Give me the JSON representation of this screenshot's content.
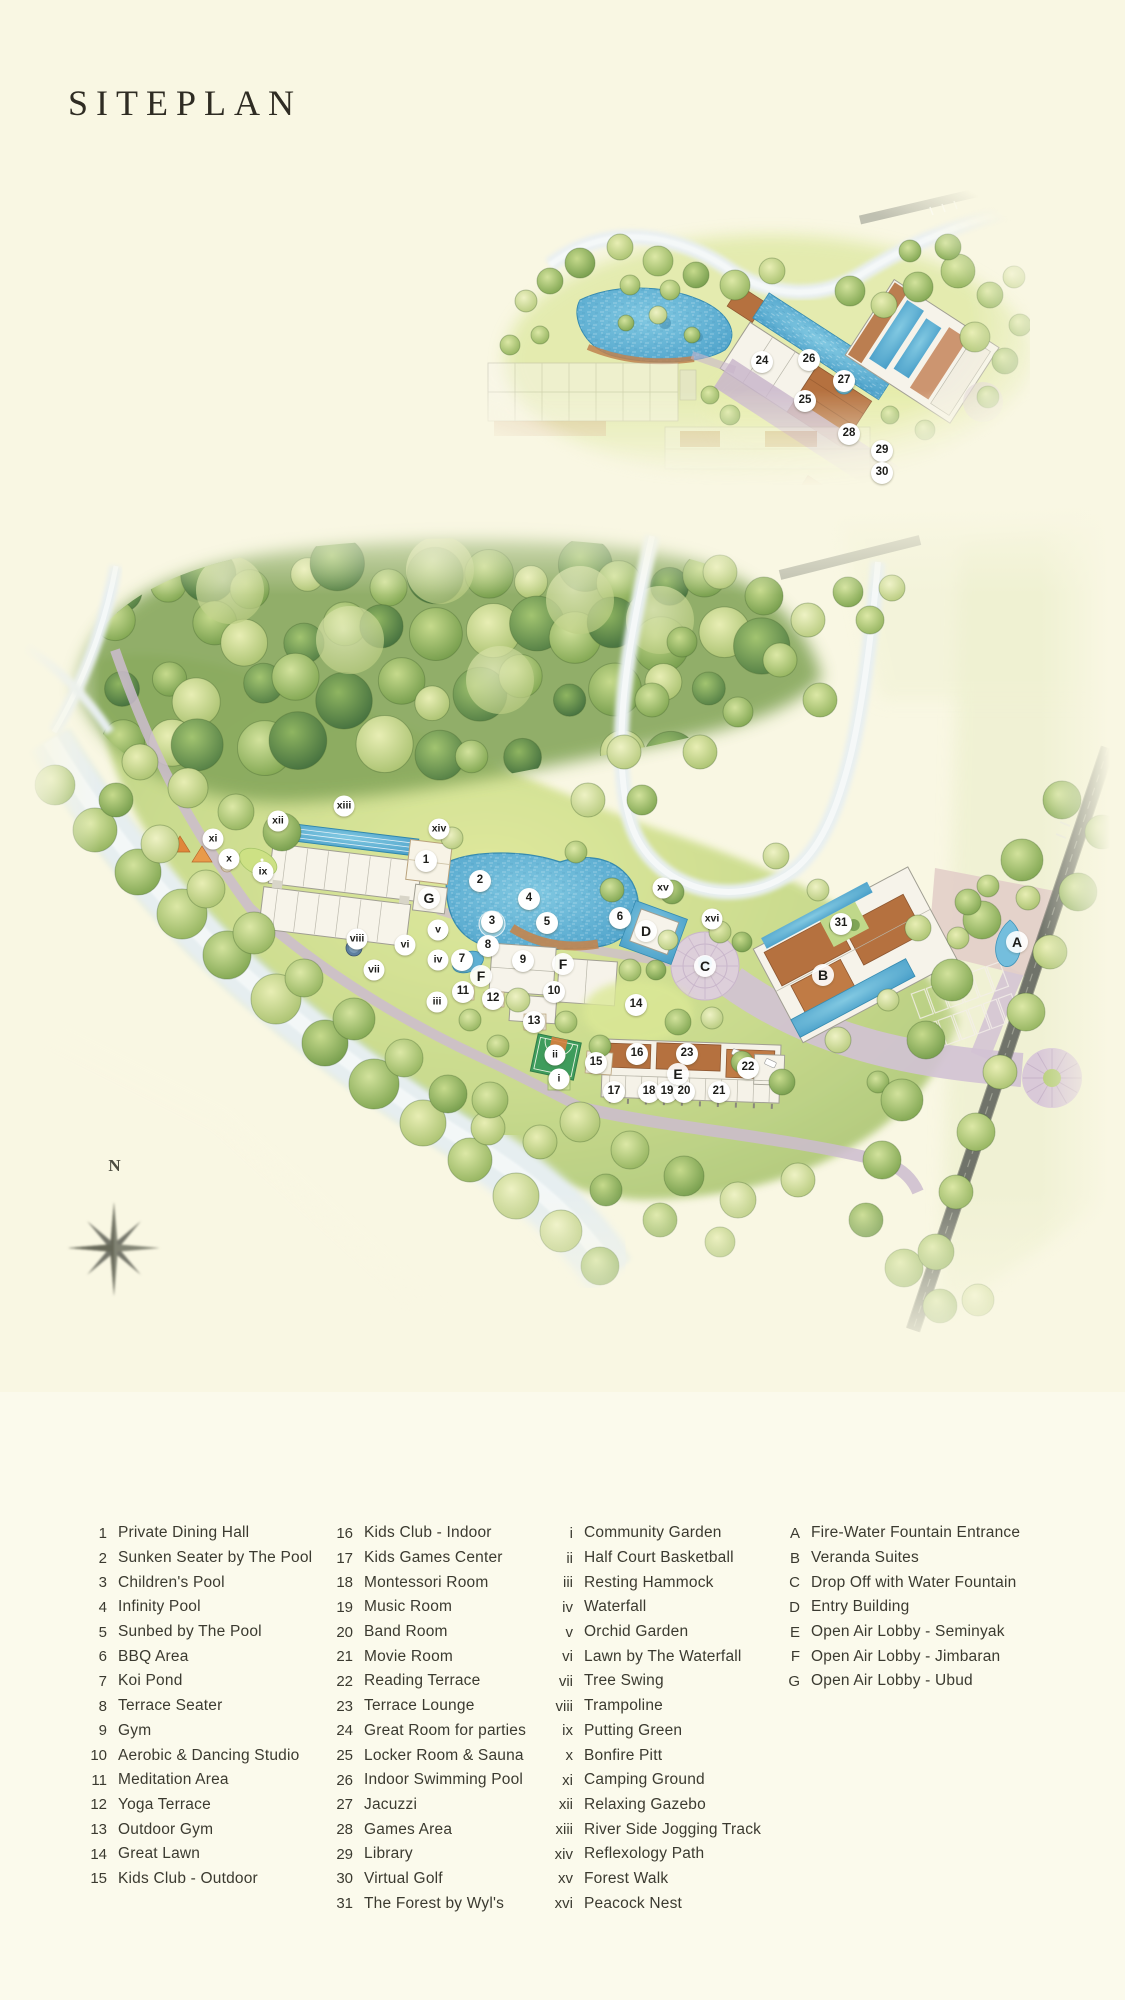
{
  "page": {
    "title": "SITEPLAN"
  },
  "compass": {
    "label": "N"
  },
  "colors": {
    "background": "#f9f7e3",
    "legend_background": "#fbfaec",
    "water": "#5fb7d8",
    "roof": "#b5713f",
    "path": "#cbb9ce",
    "title_text": "#2f2c23",
    "legend_text": "#3b3a30"
  },
  "legend": {
    "columns": [
      {
        "items": [
          {
            "key": "1",
            "label": "Private Dining Hall"
          },
          {
            "key": "2",
            "label": "Sunken Seater by The Pool"
          },
          {
            "key": "3",
            "label": "Children's Pool"
          },
          {
            "key": "4",
            "label": "Infinity Pool"
          },
          {
            "key": "5",
            "label": "Sunbed by The Pool"
          },
          {
            "key": "6",
            "label": "BBQ Area"
          },
          {
            "key": "7",
            "label": "Koi Pond"
          },
          {
            "key": "8",
            "label": "Terrace Seater"
          },
          {
            "key": "9",
            "label": "Gym"
          },
          {
            "key": "10",
            "label": "Aerobic & Dancing Studio"
          },
          {
            "key": "11",
            "label": "Meditation Area"
          },
          {
            "key": "12",
            "label": "Yoga Terrace"
          },
          {
            "key": "13",
            "label": "Outdoor Gym"
          },
          {
            "key": "14",
            "label": "Great Lawn"
          },
          {
            "key": "15",
            "label": "Kids Club - Outdoor"
          }
        ]
      },
      {
        "items": [
          {
            "key": "16",
            "label": "Kids Club - Indoor"
          },
          {
            "key": "17",
            "label": "Kids Games Center"
          },
          {
            "key": "18",
            "label": "Montessori Room"
          },
          {
            "key": "19",
            "label": "Music Room"
          },
          {
            "key": "20",
            "label": "Band Room"
          },
          {
            "key": "21",
            "label": "Movie Room"
          },
          {
            "key": "22",
            "label": "Reading Terrace"
          },
          {
            "key": "23",
            "label": "Terrace Lounge"
          },
          {
            "key": "24",
            "label": "Great Room for parties"
          },
          {
            "key": "25",
            "label": "Locker Room & Sauna"
          },
          {
            "key": "26",
            "label": "Indoor Swimming Pool"
          },
          {
            "key": "27",
            "label": "Jacuzzi"
          },
          {
            "key": "28",
            "label": "Games Area"
          },
          {
            "key": "29",
            "label": "Library"
          },
          {
            "key": "30",
            "label": "Virtual Golf"
          },
          {
            "key": "31",
            "label": "The Forest by Wyl's"
          }
        ]
      },
      {
        "items": [
          {
            "key": "i",
            "label": "Community Garden"
          },
          {
            "key": "ii",
            "label": "Half Court Basketball"
          },
          {
            "key": "iii",
            "label": "Resting Hammock"
          },
          {
            "key": "iv",
            "label": "Waterfall"
          },
          {
            "key": "v",
            "label": "Orchid Garden"
          },
          {
            "key": "vi",
            "label": "Lawn by The Waterfall"
          },
          {
            "key": "vii",
            "label": "Tree Swing"
          },
          {
            "key": "viii",
            "label": "Trampoline"
          },
          {
            "key": "ix",
            "label": "Putting Green"
          },
          {
            "key": "x",
            "label": "Bonfire Pitt"
          },
          {
            "key": "xi",
            "label": "Camping Ground"
          },
          {
            "key": "xii",
            "label": "Relaxing Gazebo"
          },
          {
            "key": "xiii",
            "label": "River Side Jogging Track"
          },
          {
            "key": "xiv",
            "label": "Reflexology Path"
          },
          {
            "key": "xv",
            "label": "Forest Walk"
          },
          {
            "key": "xvi",
            "label": "Peacock Nest"
          }
        ]
      },
      {
        "items": [
          {
            "key": "A",
            "label": "Fire-Water Fountain Entrance"
          },
          {
            "key": "B",
            "label": "Veranda Suites"
          },
          {
            "key": "C",
            "label": "Drop Off with Water Fountain"
          },
          {
            "key": "D",
            "label": "Entry Building"
          },
          {
            "key": "E",
            "label": "Open Air Lobby - Seminyak"
          },
          {
            "key": "F",
            "label": "Open Air Lobby - Jimbaran"
          },
          {
            "key": "G",
            "label": "Open Air Lobby - Ubud"
          }
        ]
      }
    ]
  },
  "small_map": {
    "markers": [
      {
        "key": "24",
        "x": 332,
        "y": 197,
        "type": "number"
      },
      {
        "key": "26",
        "x": 379,
        "y": 195,
        "type": "number"
      },
      {
        "key": "27",
        "x": 414,
        "y": 216,
        "type": "number"
      },
      {
        "key": "25",
        "x": 375,
        "y": 236,
        "type": "number"
      },
      {
        "key": "28",
        "x": 419,
        "y": 269,
        "type": "number"
      },
      {
        "key": "29",
        "x": 452,
        "y": 286,
        "type": "number"
      },
      {
        "key": "30",
        "x": 452,
        "y": 308,
        "type": "number"
      }
    ]
  },
  "main_map": {
    "markers": [
      {
        "key": "xi",
        "x": 193,
        "y": 339,
        "type": "roman"
      },
      {
        "key": "xii",
        "x": 258,
        "y": 321,
        "type": "roman"
      },
      {
        "key": "xiii",
        "x": 324,
        "y": 306,
        "type": "roman"
      },
      {
        "key": "xiv",
        "x": 419,
        "y": 329,
        "type": "roman"
      },
      {
        "key": "x",
        "x": 209,
        "y": 359,
        "type": "roman"
      },
      {
        "key": "ix",
        "x": 243,
        "y": 372,
        "type": "roman"
      },
      {
        "key": "viii",
        "x": 337,
        "y": 439,
        "type": "roman"
      },
      {
        "key": "vii",
        "x": 354,
        "y": 470,
        "type": "roman"
      },
      {
        "key": "vi",
        "x": 385,
        "y": 445,
        "type": "roman"
      },
      {
        "key": "v",
        "x": 418,
        "y": 430,
        "type": "roman"
      },
      {
        "key": "iv",
        "x": 418,
        "y": 460,
        "type": "roman"
      },
      {
        "key": "iii",
        "x": 417,
        "y": 502,
        "type": "roman"
      },
      {
        "key": "ii",
        "x": 535,
        "y": 555,
        "type": "roman"
      },
      {
        "key": "i",
        "x": 539,
        "y": 579,
        "type": "roman"
      },
      {
        "key": "xv",
        "x": 643,
        "y": 388,
        "type": "roman"
      },
      {
        "key": "xvi",
        "x": 692,
        "y": 419,
        "type": "roman"
      },
      {
        "key": "1",
        "x": 406,
        "y": 361,
        "type": "number"
      },
      {
        "key": "2",
        "x": 460,
        "y": 381,
        "type": "number"
      },
      {
        "key": "3",
        "x": 472,
        "y": 422,
        "type": "number"
      },
      {
        "key": "4",
        "x": 509,
        "y": 399,
        "type": "number"
      },
      {
        "key": "5",
        "x": 527,
        "y": 423,
        "type": "number"
      },
      {
        "key": "6",
        "x": 600,
        "y": 418,
        "type": "number"
      },
      {
        "key": "7",
        "x": 442,
        "y": 460,
        "type": "number"
      },
      {
        "key": "8",
        "x": 468,
        "y": 446,
        "type": "number"
      },
      {
        "key": "9",
        "x": 503,
        "y": 461,
        "type": "number"
      },
      {
        "key": "10",
        "x": 534,
        "y": 492,
        "type": "number"
      },
      {
        "key": "11",
        "x": 443,
        "y": 492,
        "type": "number"
      },
      {
        "key": "12",
        "x": 473,
        "y": 499,
        "type": "number"
      },
      {
        "key": "13",
        "x": 514,
        "y": 522,
        "type": "number"
      },
      {
        "key": "14",
        "x": 616,
        "y": 505,
        "type": "number"
      },
      {
        "key": "15",
        "x": 576,
        "y": 563,
        "type": "number"
      },
      {
        "key": "16",
        "x": 617,
        "y": 554,
        "type": "number"
      },
      {
        "key": "17",
        "x": 594,
        "y": 592,
        "type": "number"
      },
      {
        "key": "18",
        "x": 629,
        "y": 592,
        "type": "number"
      },
      {
        "key": "19",
        "x": 647,
        "y": 592,
        "type": "number"
      },
      {
        "key": "20",
        "x": 664,
        "y": 592,
        "type": "number"
      },
      {
        "key": "21",
        "x": 699,
        "y": 592,
        "type": "number"
      },
      {
        "key": "22",
        "x": 728,
        "y": 568,
        "type": "number"
      },
      {
        "key": "23",
        "x": 667,
        "y": 554,
        "type": "number"
      },
      {
        "key": "31",
        "x": 821,
        "y": 424,
        "type": "number"
      },
      {
        "key": "A",
        "x": 997,
        "y": 442,
        "type": "letter"
      },
      {
        "key": "B",
        "x": 803,
        "y": 475,
        "type": "letter"
      },
      {
        "key": "C",
        "x": 685,
        "y": 466,
        "type": "letter"
      },
      {
        "key": "D",
        "x": 626,
        "y": 431,
        "type": "letter"
      },
      {
        "key": "E",
        "x": 658,
        "y": 574,
        "type": "letter"
      },
      {
        "key": "F",
        "x": 543,
        "y": 464,
        "type": "letter"
      },
      {
        "key": "F",
        "x": 461,
        "y": 476,
        "type": "letter"
      },
      {
        "key": "G",
        "x": 409,
        "y": 398,
        "type": "letter"
      }
    ]
  }
}
